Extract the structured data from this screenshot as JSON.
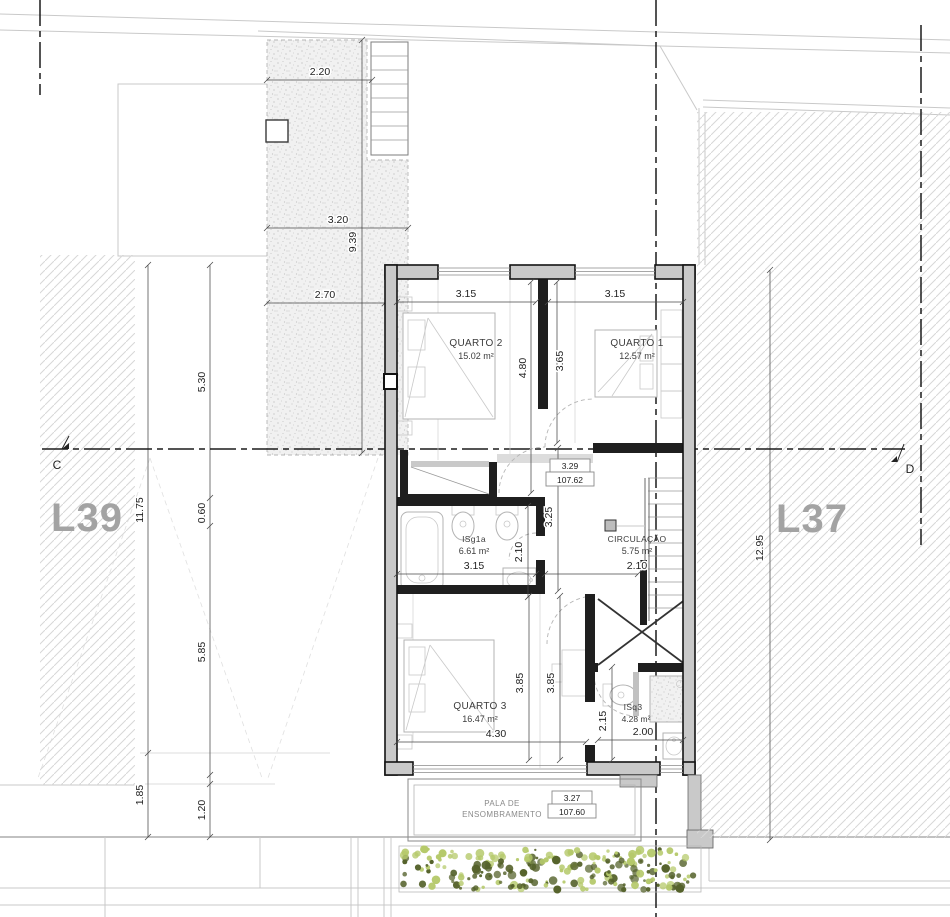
{
  "drawing": {
    "lots": {
      "left_label": "L39",
      "right_label": "L37"
    },
    "section": {
      "left_marker": "C",
      "right_marker": "D"
    },
    "rooms": {
      "quarto2": {
        "name": "QUARTO 2",
        "area": "15.02 m²",
        "width": "3.15",
        "height": "4.80"
      },
      "quarto1": {
        "name": "QUARTO 1",
        "area": "12.57 m²",
        "width": "3.15",
        "height": "3.65"
      },
      "isg1a": {
        "name": "ISg1a",
        "area": "6.61 m²",
        "width": "3.15",
        "height": "2.10"
      },
      "circulacao": {
        "name": "CIRCULAÇÃO",
        "area": "5.75 m²",
        "width": "2.10",
        "height": "3.25"
      },
      "quarto3": {
        "name": "QUARTO 3",
        "area": "16.47 m²",
        "width": "4.30",
        "height_a": "3.85",
        "height_b": "3.85"
      },
      "isq3": {
        "name": "ISq3",
        "area": "4.28 m²",
        "width": "2.00",
        "height": "2.15"
      }
    },
    "site_dims": {
      "court_top": "2.20",
      "court_mid": "3.20",
      "court_bottom": "2.70",
      "court_depth": "9.39",
      "left_a": "5.30",
      "left_b": "0.60",
      "left_c": "11.75",
      "left_d": "5.85",
      "left_e": "1.85",
      "left_f": "1.20",
      "right_depth": "12.95"
    },
    "levels": {
      "upper": {
        "relative": "3.29",
        "absolute": "107.62"
      },
      "lower": {
        "relative": "3.27",
        "absolute": "107.60"
      }
    },
    "canopy": {
      "line1": "PALA DE",
      "line2": "ENSOMBRAMENTO"
    },
    "colors": {
      "wall_fill": "#c9c9c9",
      "wall_stroke": "#141414",
      "hatch_line": "#d7d7d7",
      "stipple_bg": "#f1f1f1",
      "hedge_light": "#b5c96a",
      "hedge_dark": "#55622b",
      "lot_label": "#a3a3a3"
    }
  }
}
